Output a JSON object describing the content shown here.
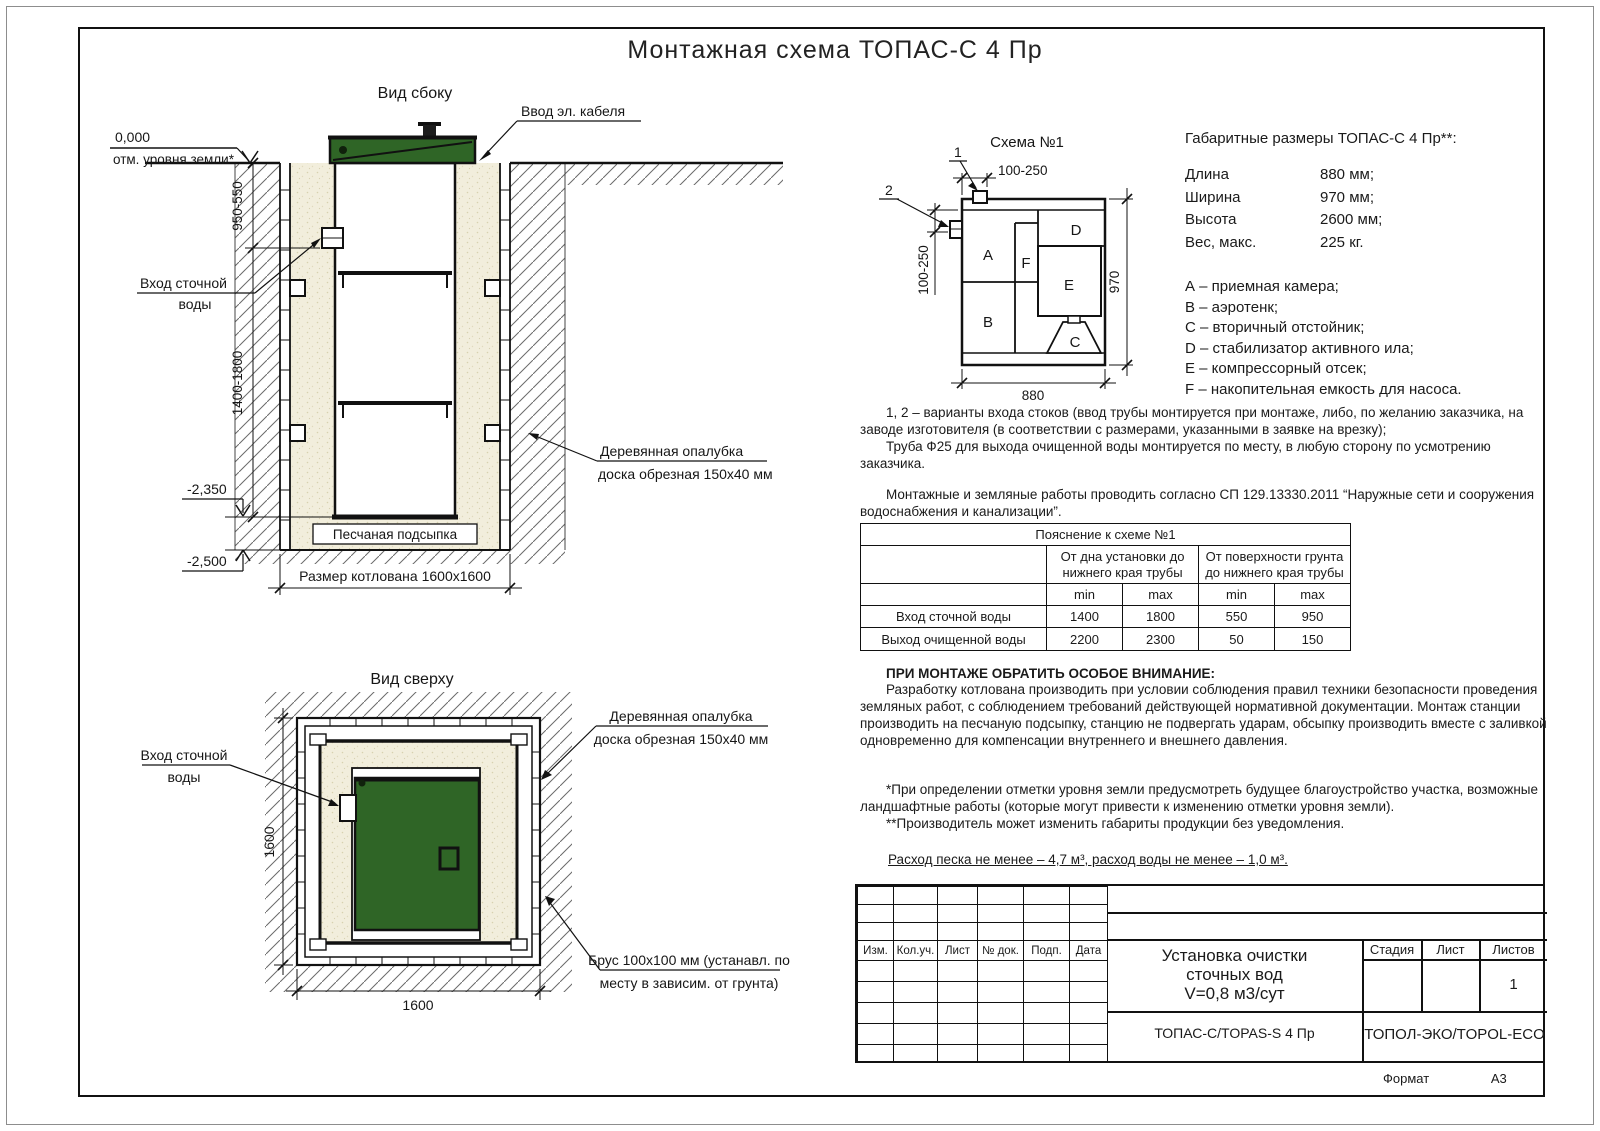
{
  "colors": {
    "line": "#161616",
    "green_lid": "#2f6526",
    "sand": "#f2eedc"
  },
  "title": "Монтажная схема ТОПАС-С 4 Пр",
  "side_view": {
    "title": "Вид сбоку",
    "cable_entry": "Ввод эл. кабеля",
    "zero_mark": "0,000",
    "ground_mark": "отм. уровня земли*",
    "inlet_line1": "Вход сточной",
    "inlet_line2": "воды",
    "dim_top": "950-550",
    "dim_mid": "1400-1800",
    "level_sand": "-2,350",
    "level_bottom": "-2,500",
    "sand_label": "Песчаная подсыпка",
    "pit_label": "Размер котлована 1600х1600",
    "formwork_line1": "Деревянная опалубка",
    "formwork_line2": "доска обрезная 150х40 мм"
  },
  "scheme": {
    "title": "Схема №1",
    "marker1": "1",
    "marker2": "2",
    "dim_top": "100-250",
    "dim_left": "100-250",
    "dim_bottom": "880",
    "dim_right": "970",
    "chambers": {
      "a": "A",
      "b": "B",
      "c": "C",
      "d": "D",
      "e": "E",
      "f": "F"
    }
  },
  "overall": {
    "title": "Габаритные размеры ТОПАС-С 4 Пр**:",
    "rows": [
      {
        "label": "Длина",
        "value": "880 мм;"
      },
      {
        "label": "Ширина",
        "value": "970 мм;"
      },
      {
        "label": "Высота",
        "value": "2600 мм;"
      },
      {
        "label": "Вес, макс.",
        "value": "225 кг."
      }
    ],
    "legend": [
      "А – приемная камера;",
      "В – аэротенк;",
      "С – вторичный отстойник;",
      "D – стабилизатор активного ила;",
      "Е – компрессорный отсек;",
      "F – накопительная емкость для насоса."
    ]
  },
  "notes": {
    "p1": "1, 2 – варианты входа  стоков (ввод трубы монтируется при монтаже, либо, по желанию заказчика, на заводе изготовителя (в соответствии с размерами, указанными в заявке на врезку);",
    "p2": "Труба Ф25 для выхода очищенной воды монтируется по месту, в любую сторону по усмотрению заказчика.",
    "p3": "Монтажные и земляные работы проводить согласно СП 129.13330.2011 “Наружные сети и сооружения водоснабжения и канализации”."
  },
  "table": {
    "title": "Пояснение к схеме №1",
    "group1": "От дна установки до нижнего края трубы",
    "group2": "От поверхности грунта до нижнего края трубы",
    "min1": "min",
    "max1": "max",
    "min2": "min",
    "max2": "max",
    "rows": [
      {
        "label": "Вход сточной воды",
        "c1": "1400",
        "c2": "1800",
        "c3": "550",
        "c4": "950"
      },
      {
        "label": "Выход очищенной воды",
        "c1": "2200",
        "c2": "2300",
        "c3": "50",
        "c4": "150"
      }
    ]
  },
  "attention": {
    "title": "ПРИ МОНТАЖЕ ОБРАТИТЬ ОСОБОЕ ВНИМАНИЕ:",
    "body": "Разработку котлована производить при условии соблюдения правил техники безопасности проведения земляных работ, с соблюдением требований действующей нормативной документации. Монтаж станции производить на песчаную подсыпку, станцию не подвергать ударам, обсыпку производить вместе с заливкой одновременно для компенсации внутреннего и внешнего давления."
  },
  "footnote1": "*При определении отметки уровня земли предусмотреть будущее благоустройство участка, возможные ландшафтные работы (которые могут привести к изменению отметки уровня земли).",
  "footnote2": "**Производитель может изменить габариты продукции без уведомления.",
  "consumption": "Расход песка не менее – 4,7 м³, расход воды не менее – 1,0 м³.",
  "top_view": {
    "title": "Вид сверху",
    "inlet_line1": "Вход сточной",
    "inlet_line2": "воды",
    "formwork_line1": "Деревянная опалубка",
    "formwork_line2": "доска обрезная 150х40 мм",
    "dim_left": "1600",
    "dim_bottom": "1600",
    "beam_line1": "Брус 100х100 мм (устанавл. по",
    "beam_line2": "месту в зависим. от грунта)"
  },
  "stamp": {
    "col1": "Изм.",
    "col2": "Кол.уч.",
    "col3": "Лист",
    "col4": "№ док.",
    "col5": "Подп.",
    "col6": "Дата",
    "doc1": "Установка очистки",
    "doc2": "сточных вод",
    "doc3": "V=0,8 м3/сут",
    "model": "ТОПАС-С/TOPAS-S 4 Пр",
    "stage": "Стадия",
    "sheet": "Лист",
    "sheets": "Листов",
    "sheets_value": "1",
    "company": "ТОПОЛ-ЭКО/TOPOL-ECO",
    "format_label": "Формат",
    "format_value": "А3"
  }
}
